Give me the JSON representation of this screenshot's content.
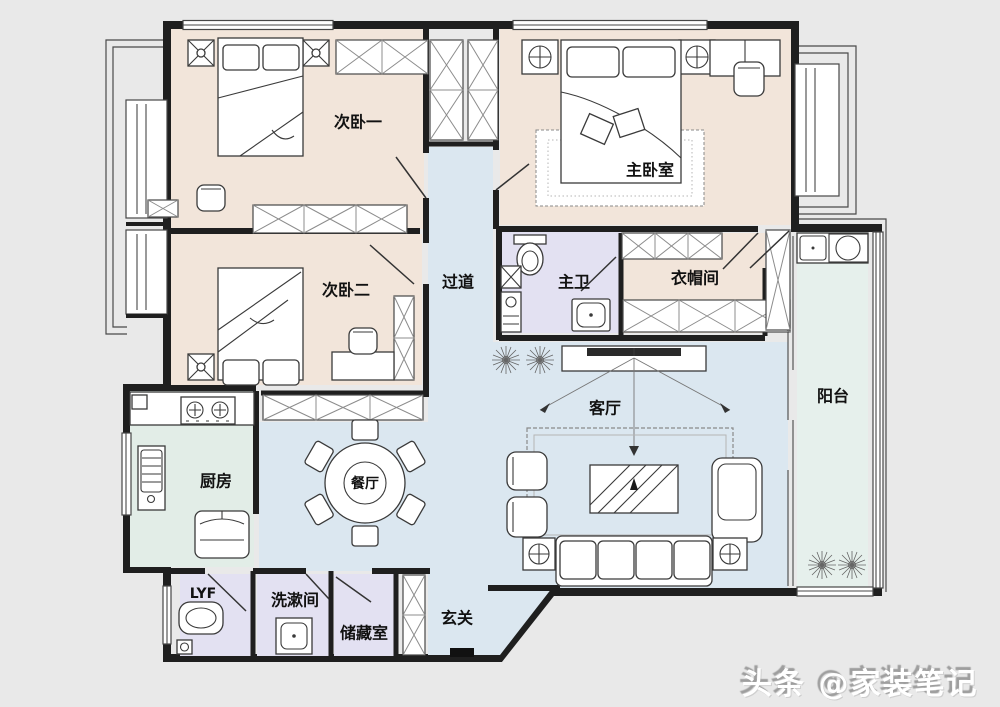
{
  "scene": {
    "type": "floor-plan",
    "description": "Three-bedroom apartment floor plan with furniture layout"
  },
  "colors": {
    "background": "#e9e9e9",
    "floor": "#ffffff",
    "wall": "#1f1f1f",
    "bedroom": "#f2e5da",
    "living": "#dbe7f0",
    "kitchen": "#e2ede7",
    "bath": "#e3e1f2",
    "balcony": "#e6f0ec"
  },
  "rooms": {
    "bedroom1": {
      "label": "次卧一"
    },
    "bedroom2": {
      "label": "次卧二"
    },
    "master_bedroom": {
      "label": "主卧室"
    },
    "hallway": {
      "label": "过道"
    },
    "master_bath": {
      "label": "主卫"
    },
    "cloakroom": {
      "label": "衣帽间"
    },
    "balcony": {
      "label": "阳台"
    },
    "living_room": {
      "label": "客厅"
    },
    "dining_room": {
      "label": "餐厅"
    },
    "kitchen": {
      "label": "厨房"
    },
    "lyf": {
      "label": "LYF"
    },
    "washroom": {
      "label": "洗漱间"
    },
    "storage": {
      "label": "储藏室"
    },
    "entry": {
      "label": "玄关"
    }
  },
  "watermark": {
    "text": "头条 @家装笔记"
  }
}
